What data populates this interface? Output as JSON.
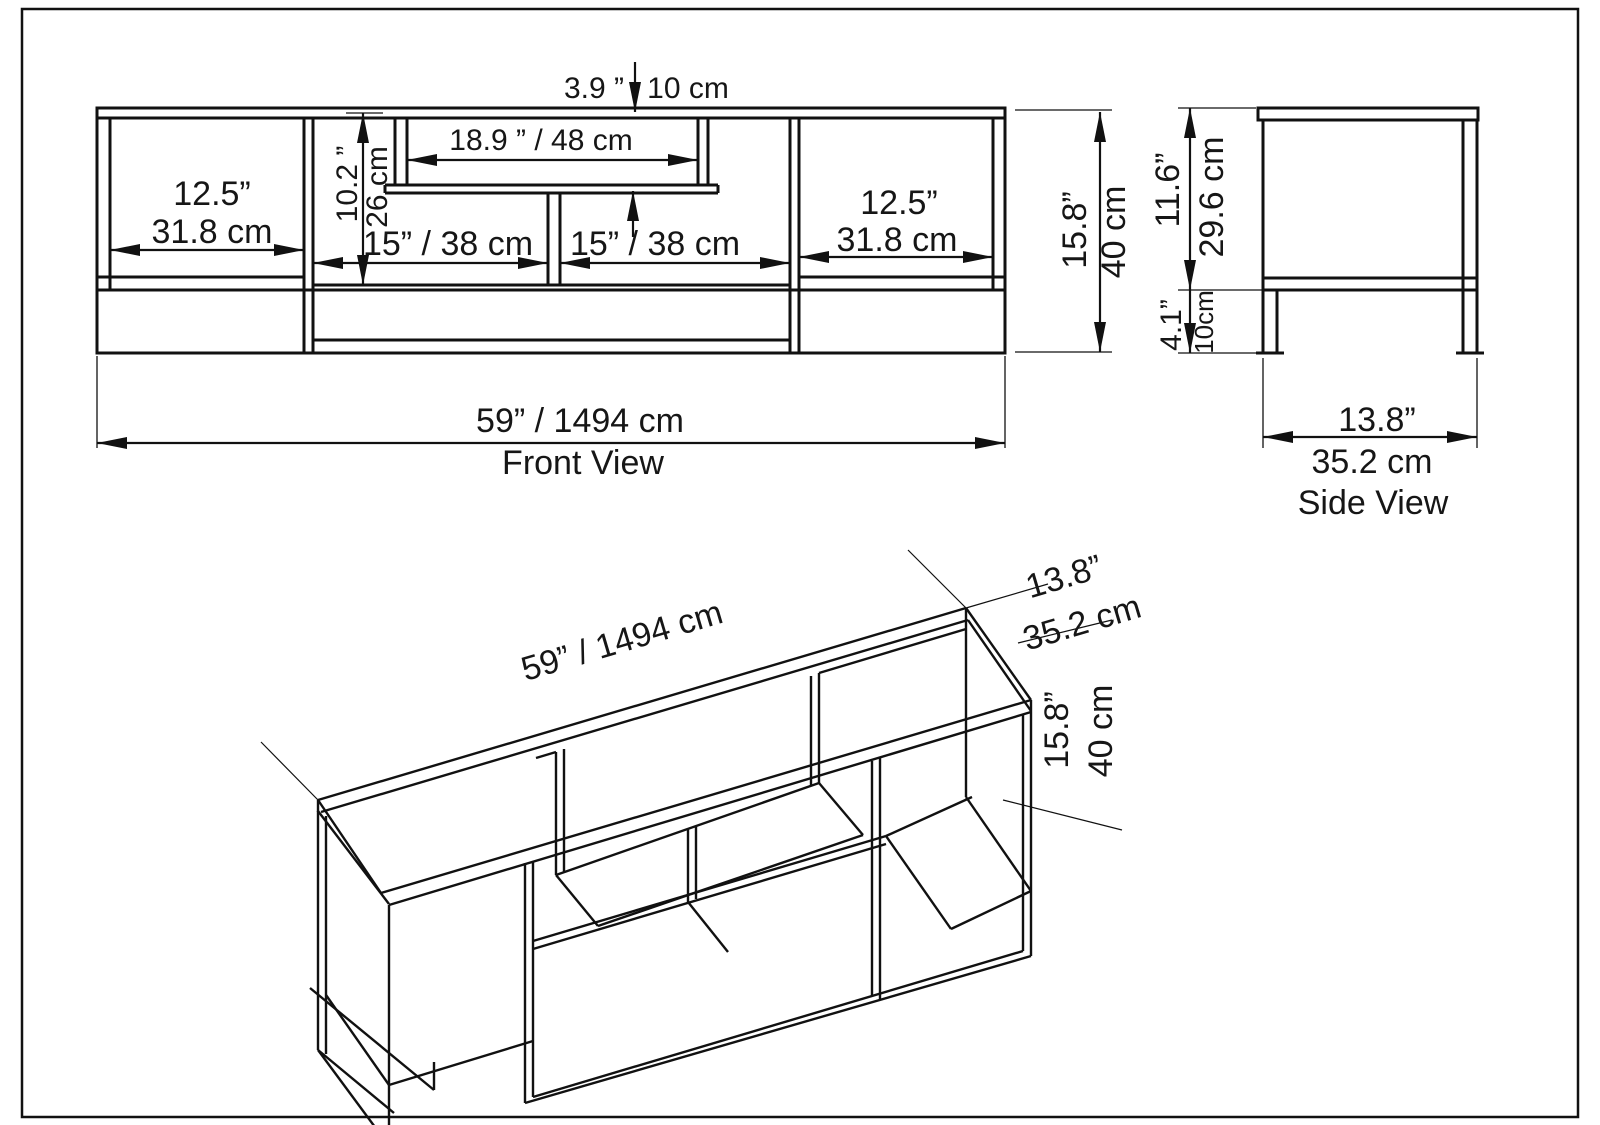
{
  "sheet": {
    "background": "#ffffff",
    "line_color": "#111111"
  },
  "front_view": {
    "title": "Front View",
    "dims": {
      "top_gap_in": "3.9 ”",
      "top_gap_cm": "10 cm",
      "tv_opening": "18.9 ” / 48 cm",
      "inner_height_in": "10.2 ”",
      "inner_height_cm": "26 cm",
      "left_comp_in": "12.5”",
      "left_comp_cm": "31.8 cm",
      "mid_left": "15” / 38 cm",
      "mid_right": "15” / 38 cm",
      "right_comp_in": "12.5”",
      "right_comp_cm": "31.8 cm",
      "height_in": "15.8”",
      "height_cm": "40 cm",
      "overall_width": "59” / 1494 cm"
    }
  },
  "side_view": {
    "title": "Side View",
    "dims": {
      "upper_height_in": "11.6”",
      "upper_height_cm": "29.6 cm",
      "leg_height_in": "4.1”",
      "leg_height_cm": "10cm",
      "depth_in": "13.8”",
      "depth_cm": "35.2 cm"
    }
  },
  "iso_view": {
    "dims": {
      "overall_width": "59” / 1494 cm",
      "depth_in": "13.8”",
      "depth_cm": "35.2 cm",
      "height_in": "15.8”",
      "height_cm": "40 cm"
    }
  }
}
